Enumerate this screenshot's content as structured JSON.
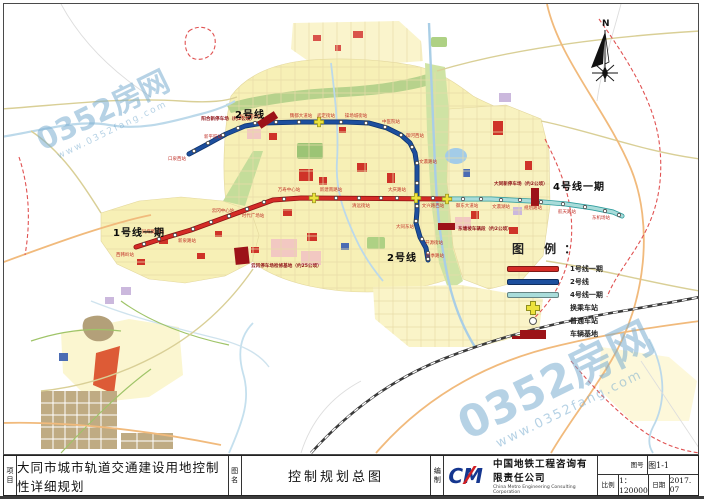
{
  "title_block": {
    "project_label": "项目",
    "project": "大同市城市轨道交通建设用地控制性详细规划",
    "drawing_label": "图名",
    "drawing": "控制规划总图",
    "producer_label": "编制",
    "logo_text": "CM",
    "company_cn": "中国地铁工程咨询有限责任公司",
    "company_en": "China Metro Engineering Consulting Corporation",
    "fig_no_label": "图号",
    "fig_no": "图1-1",
    "scale_label": "比例",
    "scale": "1：120000",
    "date_label": "日期",
    "date": "2017. 07"
  },
  "legend": {
    "title": "图 例：",
    "items": [
      {
        "label": "1号线一期",
        "type": "line",
        "color": "#d42b26"
      },
      {
        "label": "2号线",
        "type": "line",
        "color": "#1d4f9e"
      },
      {
        "label": "4号线一期",
        "type": "line",
        "color": "#a9dcda"
      },
      {
        "label": "换乘车站",
        "type": "cross",
        "color": "#ece23c"
      },
      {
        "label": "普通车站",
        "type": "dot",
        "color": "#ffffff"
      },
      {
        "label": "车辆基地",
        "type": "rect",
        "color": "#9c1318"
      }
    ]
  },
  "map": {
    "north_label": "N",
    "watermark": {
      "text": "0352房网",
      "sub": "www.0352fang.com"
    },
    "line_labels": [
      {
        "t": "2号线",
        "x": 234,
        "y": 117
      },
      {
        "t": "1号线一期",
        "x": 112,
        "y": 235
      },
      {
        "t": "4号线一期",
        "x": 552,
        "y": 189
      },
      {
        "t": "2号线",
        "x": 386,
        "y": 260
      }
    ],
    "lines": [
      {
        "name": "1号线一期",
        "color": "#d42b26",
        "casing": "#8f1212",
        "width": 3.4,
        "points": [
          [
            135,
            246
          ],
          [
            160,
            238
          ],
          [
            190,
            229
          ],
          [
            220,
            218
          ],
          [
            250,
            207
          ],
          [
            272,
            199
          ],
          [
            300,
            197
          ],
          [
            446,
            198
          ]
        ]
      },
      {
        "name": "2号线",
        "color": "#1d4f9e",
        "casing": "#0e3570",
        "width": 3.4,
        "points": [
          [
            188,
            153
          ],
          [
            205,
            144
          ],
          [
            225,
            133
          ],
          [
            244,
            125
          ],
          [
            262,
            122
          ],
          [
            300,
            121
          ],
          [
            345,
            121
          ],
          [
            368,
            122
          ],
          [
            386,
            127
          ],
          [
            400,
            134
          ],
          [
            409,
            142
          ],
          [
            414,
            152
          ],
          [
            416,
            165
          ],
          [
            416,
            210
          ],
          [
            415,
            222
          ],
          [
            419,
            236
          ],
          [
            425,
            247
          ],
          [
            427,
            259
          ]
        ]
      },
      {
        "name": "4号线一期",
        "color": "#a9dcda",
        "casing": "#2f9d9d",
        "width": 3.4,
        "points": [
          [
            446,
            198
          ],
          [
            490,
            198
          ],
          [
            530,
            200
          ],
          [
            565,
            203
          ],
          [
            592,
            207
          ],
          [
            612,
            211
          ],
          [
            621,
            215
          ]
        ]
      }
    ],
    "stations": [
      [
        143,
        243
      ],
      [
        158,
        238
      ],
      [
        174,
        234
      ],
      [
        192,
        228
      ],
      [
        210,
        221
      ],
      [
        228,
        215
      ],
      [
        246,
        208
      ],
      [
        263,
        201
      ],
      [
        283,
        198
      ],
      [
        335,
        197
      ],
      [
        358,
        197
      ],
      [
        380,
        197
      ],
      [
        396,
        197
      ],
      [
        432,
        197
      ],
      [
        193,
        150
      ],
      [
        207,
        142
      ],
      [
        222,
        134
      ],
      [
        237,
        127
      ],
      [
        254,
        122
      ],
      [
        275,
        121
      ],
      [
        298,
        121
      ],
      [
        340,
        121
      ],
      [
        365,
        122
      ],
      [
        384,
        126
      ],
      [
        400,
        134
      ],
      [
        411,
        146
      ],
      [
        416,
        162
      ],
      [
        416,
        182
      ],
      [
        416,
        205
      ],
      [
        415,
        220
      ],
      [
        421,
        238
      ],
      [
        427,
        252
      ],
      [
        427,
        258
      ],
      [
        462,
        198
      ],
      [
        480,
        198
      ],
      [
        500,
        199
      ],
      [
        519,
        199
      ],
      [
        540,
        201
      ],
      [
        562,
        203
      ],
      [
        584,
        206
      ],
      [
        604,
        210
      ],
      [
        618,
        214
      ]
    ],
    "transfers": [
      [
        318,
        121
      ],
      [
        313,
        197
      ],
      [
        415,
        197
      ],
      [
        446,
        198
      ]
    ],
    "depots": [
      {
        "x": 256,
        "y": 121,
        "w": 20,
        "h": 8,
        "rot": -33
      },
      {
        "x": 233,
        "y": 247,
        "w": 14,
        "h": 17,
        "rot": -6
      },
      {
        "x": 530,
        "y": 187,
        "w": 8,
        "h": 18,
        "rot": 0
      },
      {
        "x": 437,
        "y": 222,
        "w": 17,
        "h": 7,
        "rot": 0
      }
    ],
    "depot_labels": [
      {
        "t": "阳合新停车场（约2公顷）",
        "x": 254,
        "y": 119,
        "a": "end"
      },
      {
        "t": "云冈停车场检修基地（约25公顷）",
        "x": 250,
        "y": 266,
        "a": "start"
      },
      {
        "t": "大同新停车场（约2公顷）",
        "x": 493,
        "y": 184,
        "a": "start"
      },
      {
        "t": "东塘坡车辆段（约2公顷）",
        "x": 457,
        "y": 229,
        "a": "start"
      }
    ],
    "station_labels": [
      {
        "t": "口泉西站",
        "x": 176,
        "y": 159
      },
      {
        "t": "新平旺站",
        "x": 212,
        "y": 137
      },
      {
        "t": "振华南街站",
        "x": 250,
        "y": 117
      },
      {
        "t": "魏都大道站",
        "x": 300,
        "y": 116
      },
      {
        "t": "武定街站",
        "x": 325,
        "y": 116
      },
      {
        "t": "操场城街站",
        "x": 355,
        "y": 116
      },
      {
        "t": "中医院站",
        "x": 390,
        "y": 122
      },
      {
        "t": "御河西站",
        "x": 414,
        "y": 136
      },
      {
        "t": "文瀛路站",
        "x": 427,
        "y": 162
      },
      {
        "t": "大同东站",
        "x": 404,
        "y": 227
      },
      {
        "t": "开源街站",
        "x": 433,
        "y": 243
      },
      {
        "t": "四季路站",
        "x": 434,
        "y": 256
      },
      {
        "t": "西韩岭站",
        "x": 124,
        "y": 255
      },
      {
        "t": "同煤集团站",
        "x": 152,
        "y": 232
      },
      {
        "t": "新泉路站",
        "x": 186,
        "y": 241
      },
      {
        "t": "云冈中心站",
        "x": 222,
        "y": 211
      },
      {
        "t": "时代广场站",
        "x": 252,
        "y": 216
      },
      {
        "t": "万寿中心站",
        "x": 288,
        "y": 190
      },
      {
        "t": "新建南路站",
        "x": 330,
        "y": 190
      },
      {
        "t": "清远街站",
        "x": 360,
        "y": 206
      },
      {
        "t": "大庆路站",
        "x": 396,
        "y": 190
      },
      {
        "t": "文兴路西站",
        "x": 432,
        "y": 206
      },
      {
        "t": "御东大道站",
        "x": 466,
        "y": 206
      },
      {
        "t": "文瀛湖站",
        "x": 500,
        "y": 207
      },
      {
        "t": "规划路站",
        "x": 532,
        "y": 208
      },
      {
        "t": "航天路站",
        "x": 566,
        "y": 212
      },
      {
        "t": "东机场站",
        "x": 600,
        "y": 218
      }
    ]
  }
}
